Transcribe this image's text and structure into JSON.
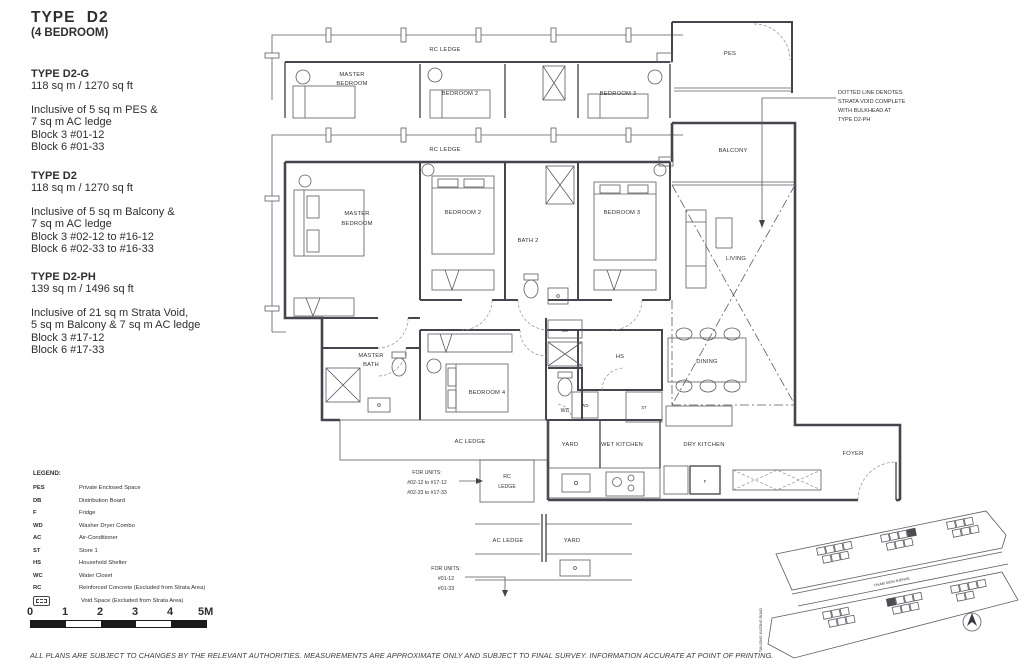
{
  "page": {
    "title": "TYPE  D2",
    "subtitle": "(4 BEDROOM)",
    "disclaimer": "ALL PLANS ARE SUBJECT TO CHANGES BY THE RELEVANT AUTHORITIES. MEASUREMENTS ARE APPROXIMATE ONLY AND SUBJECT TO FINAL SURVEY. INFORMATION ACCURATE AT POINT OF PRINTING."
  },
  "variants": [
    {
      "name": "TYPE D2-G",
      "area": "118 sq m / 1270 sq ft",
      "lines": [
        "Inclusive of 5 sq m PES &",
        "7 sq m AC ledge",
        "Block 3  #01-12",
        "Block 6  #01-33"
      ]
    },
    {
      "name": "TYPE D2",
      "area": "118 sq m / 1270 sq ft",
      "lines": [
        "Inclusive of 5 sq m Balcony &",
        "7 sq m AC ledge",
        "Block 3  #02-12 to #16-12",
        "Block 6  #02-33 to #16-33"
      ]
    },
    {
      "name": "TYPE D2-PH",
      "area": "139 sq m / 1496 sq ft",
      "lines": [
        "Inclusive of 21 sq m Strata Void,",
        "5 sq m Balcony & 7 sq m AC ledge",
        "Block 3  #17-12",
        "Block 6  #17-33"
      ]
    }
  ],
  "legend": {
    "title": "LEGEND:",
    "items": [
      {
        "abbr": "PES",
        "desc": "Private Enclosed Space"
      },
      {
        "abbr": "DB",
        "desc": "Distribution Board"
      },
      {
        "abbr": "F",
        "desc": "Fridge"
      },
      {
        "abbr": "WD",
        "desc": "Washer Dryer Combo"
      },
      {
        "abbr": "AC",
        "desc": "Air-Conditioner"
      },
      {
        "abbr": "ST",
        "desc": "Store 1"
      },
      {
        "abbr": "HS",
        "desc": "Household Shelter"
      },
      {
        "abbr": "WC",
        "desc": "Water Closet"
      },
      {
        "abbr": "RC",
        "desc": "Reinforced Concrete (Excluded from Strata Area)"
      },
      {
        "icon": "void-space-icon",
        "desc": "Void Space (Excluded from Strata Area)"
      }
    ]
  },
  "scale": {
    "labels": [
      "0",
      "1",
      "2",
      "3",
      "4",
      "5M"
    ]
  },
  "strata_note": {
    "l1": "DOTTED LINE DENOTES",
    "l2": "STRATA VOID COMPLETE",
    "l3": "WITH BULKHEAD AT",
    "l4": "TYPE D2-PH"
  },
  "rooms": {
    "rc_ledge": "RC LEDGE",
    "master_1": "MASTER",
    "master_2": "BEDROOM",
    "bedroom2": "BEDROOM 2",
    "bedroom3": "BEDROOM 3",
    "bedroom4": "BEDROOM 4",
    "bath2": "BATH 2",
    "master_bath_1": "MASTER",
    "master_bath_2": "BATH",
    "pes": "PES",
    "balcony": "BALCONY",
    "living": "LIVING",
    "dining": "DINING",
    "foyer": "FOYER",
    "yard": "YARD",
    "wet_kitchen": "WET KITCHEN",
    "dry_kitchen": "DRY KITCHEN",
    "ac_ledge": "AC LEDGE",
    "wc": "WC",
    "hs": "HS",
    "db": "DB",
    "wd": "WD",
    "st": "ST",
    "f": "F",
    "rc": "RC",
    "ledge": "LEDGE"
  },
  "units_notes": {
    "upper": {
      "l1": "FOR UNITS:",
      "l2": "#02-12 to #17-12",
      "l3": "#02-33 to #17-33"
    },
    "lower": {
      "l1": "FOR UNITS:",
      "l2": "#01-12",
      "l3": "#01-33"
    }
  },
  "site_map": {
    "road": "THIAM  SIEW  AVENUE",
    "side_road": "TANJONG KATONG ROAD"
  }
}
